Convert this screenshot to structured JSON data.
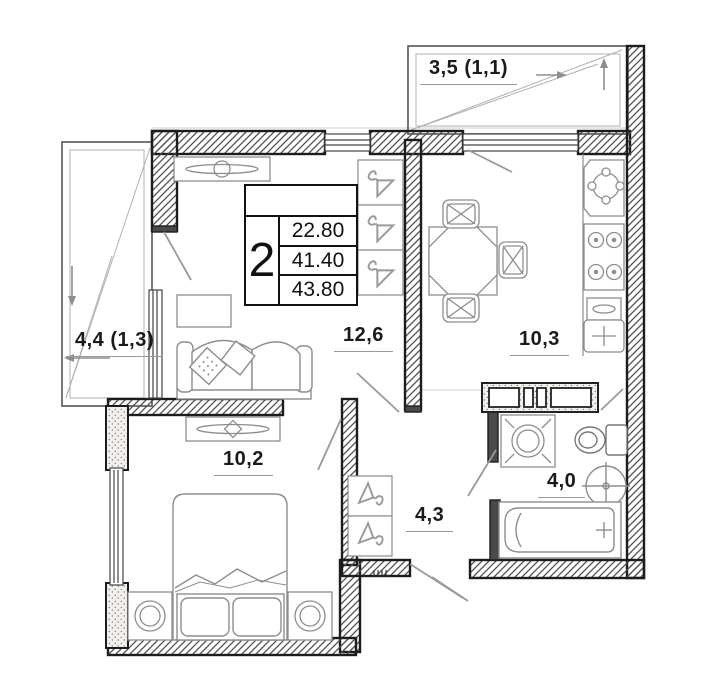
{
  "title": "2-room apartment floor plan",
  "legend": {
    "rooms_count": "2",
    "living_area": "22.80",
    "apartment_area": "41.40",
    "total_area": "43.80"
  },
  "areas": {
    "living_room": "12,6",
    "kitchen": "10,3",
    "bedroom": "10,2",
    "hallway": "4,3",
    "bathroom": "4,0",
    "balcony_top": "3,5 (1,1)",
    "balcony_left": "4,4 (1,3)"
  },
  "colors": {
    "wall_line": "#1c1c1c",
    "furniture_line": "#8d8d8d",
    "door_swing": "#9a9a9a",
    "text": "#1a1a1a"
  }
}
